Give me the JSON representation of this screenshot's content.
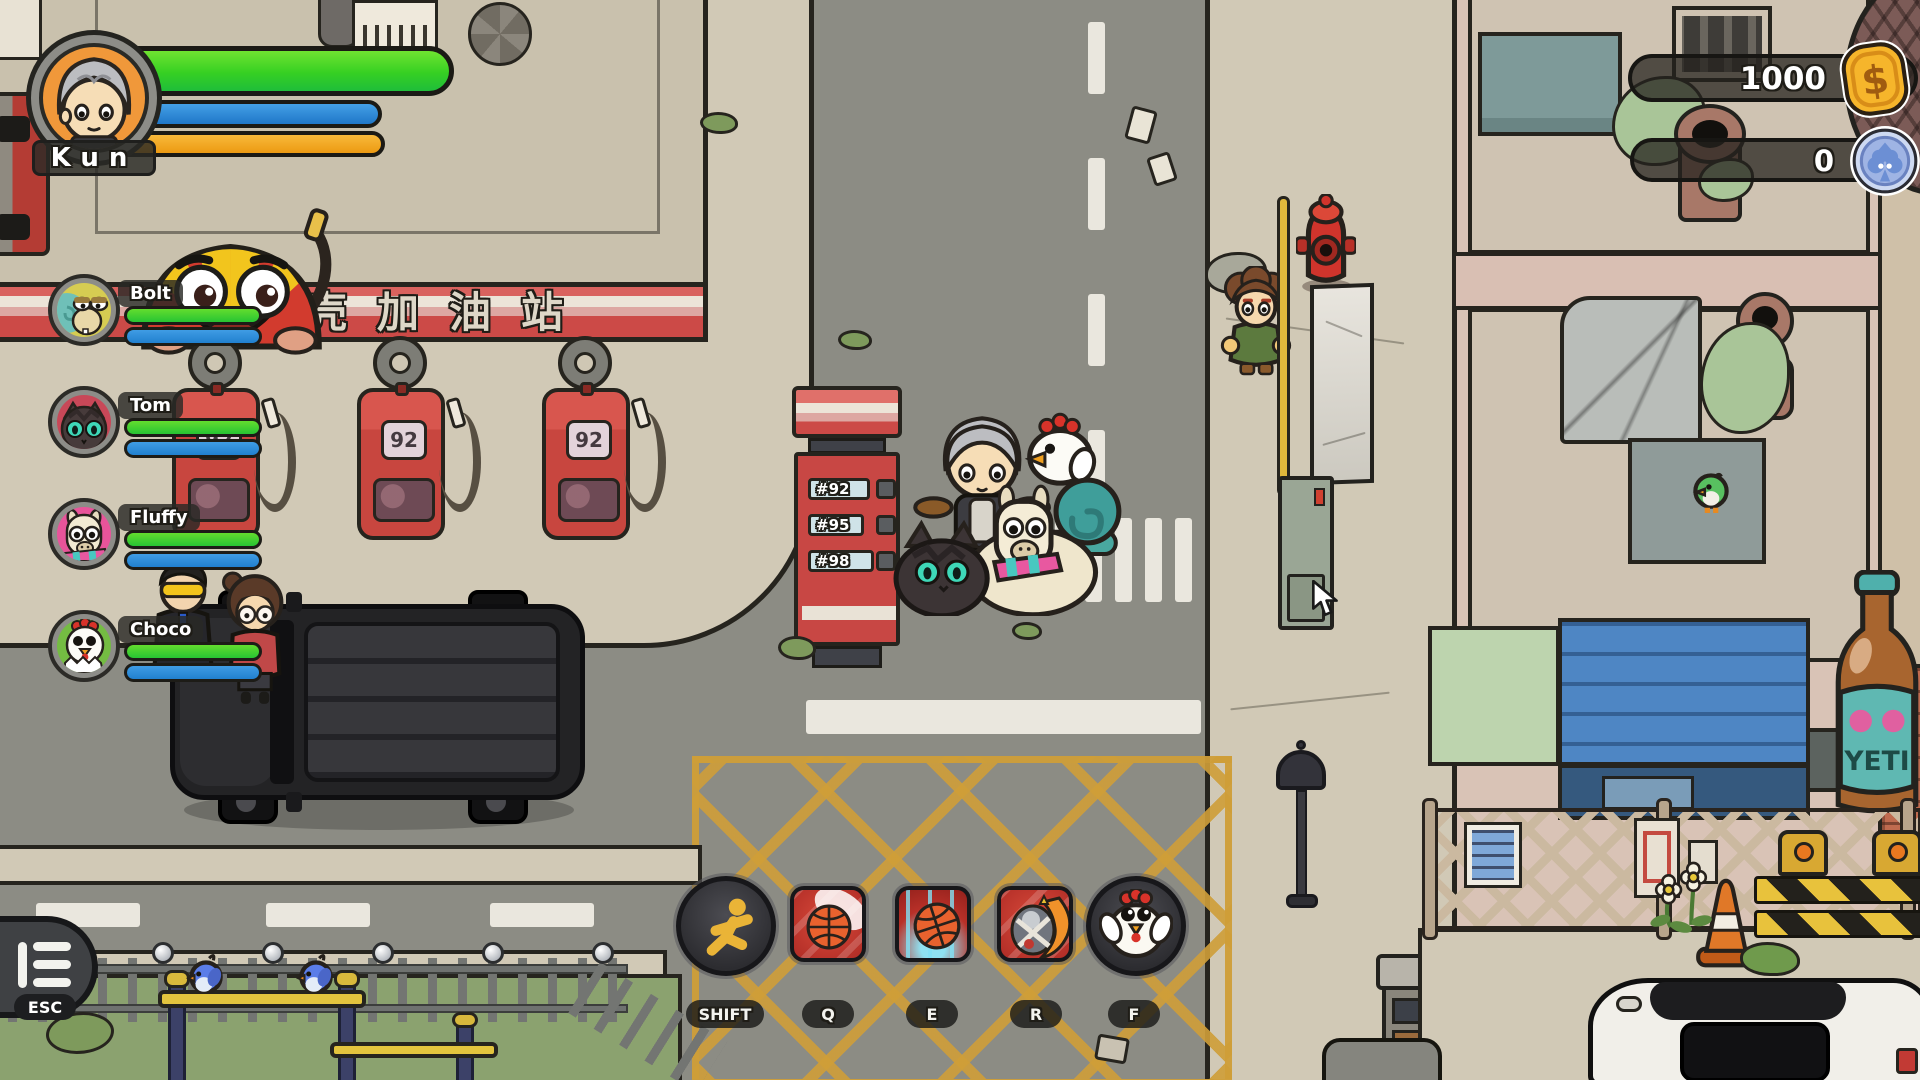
{
  "hud": {
    "player": {
      "name": "Kun"
    },
    "party": [
      {
        "name": "Bolt"
      },
      {
        "name": "Tom"
      },
      {
        "name": "Fluffy"
      },
      {
        "name": "Choco"
      }
    ],
    "currency": [
      {
        "label": "gold-coins",
        "value": "1000"
      },
      {
        "label": "club-tokens",
        "value": "0"
      }
    ],
    "skills": [
      {
        "key": "SHIFT",
        "icon": "sprint-icon"
      },
      {
        "key": "Q",
        "icon": "basketball-throw-icon"
      },
      {
        "key": "E",
        "icon": "basketball-slam-icon"
      },
      {
        "key": "R",
        "icon": "bird-flame-icon"
      },
      {
        "key": "F",
        "icon": "chicken-icon"
      }
    ],
    "esc": {
      "label": "ESC"
    }
  },
  "world": {
    "gas_station": {
      "sign_text": "壳壳加油站",
      "pump_label": "92",
      "price_board": [
        "#92",
        "#95",
        "#98"
      ]
    },
    "poster_brand": "YETI"
  },
  "colors": {
    "hp_green": "#36d023",
    "mp_blue": "#2180cf",
    "energy_orange": "#f2a51f",
    "awning_red": "#cc4a47",
    "coin_gold": "#f6b52b",
    "token_blue": "#9fb4e4",
    "road_gray": "#8c8c84",
    "sidewalk_tan": "#d1c9b6"
  }
}
